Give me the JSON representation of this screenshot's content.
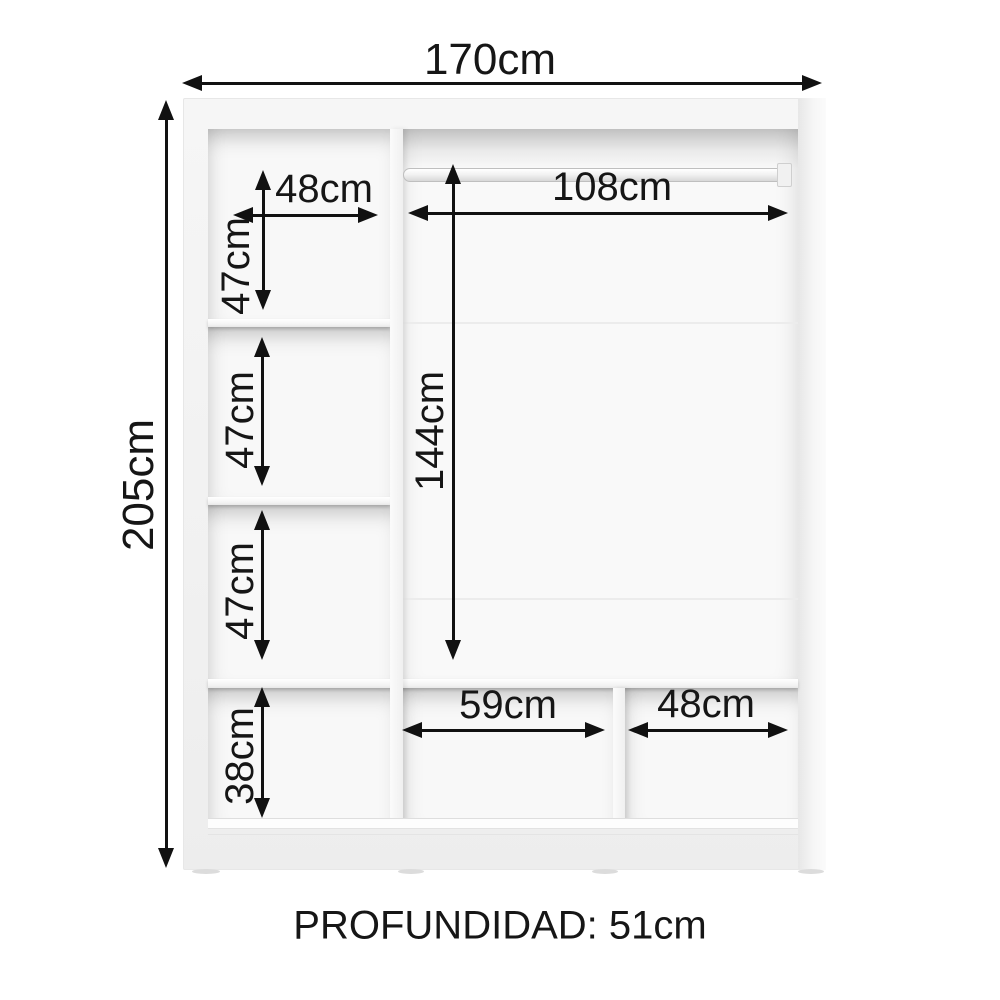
{
  "diagram": {
    "type": "furniture-dimension-diagram",
    "depth_note": "PROFUNDIDAD: 51cm",
    "dims": {
      "total_width": "170cm",
      "total_height": "205cm",
      "left_shelf_width": "48cm",
      "left_cubby1_height": "47cm",
      "left_cubby2_height": "47cm",
      "left_cubby3_height": "47cm",
      "left_bottom_height": "38cm",
      "rod_width": "108cm",
      "rod_section_height": "144cm",
      "bottom_middle_width": "59cm",
      "bottom_right_width": "48cm"
    },
    "colors": {
      "background": "#ffffff",
      "text": "#161616",
      "arrow": "#111111",
      "cabinet_body": "#f2f2f2",
      "cabinet_interior": "#f8f8f8"
    }
  }
}
